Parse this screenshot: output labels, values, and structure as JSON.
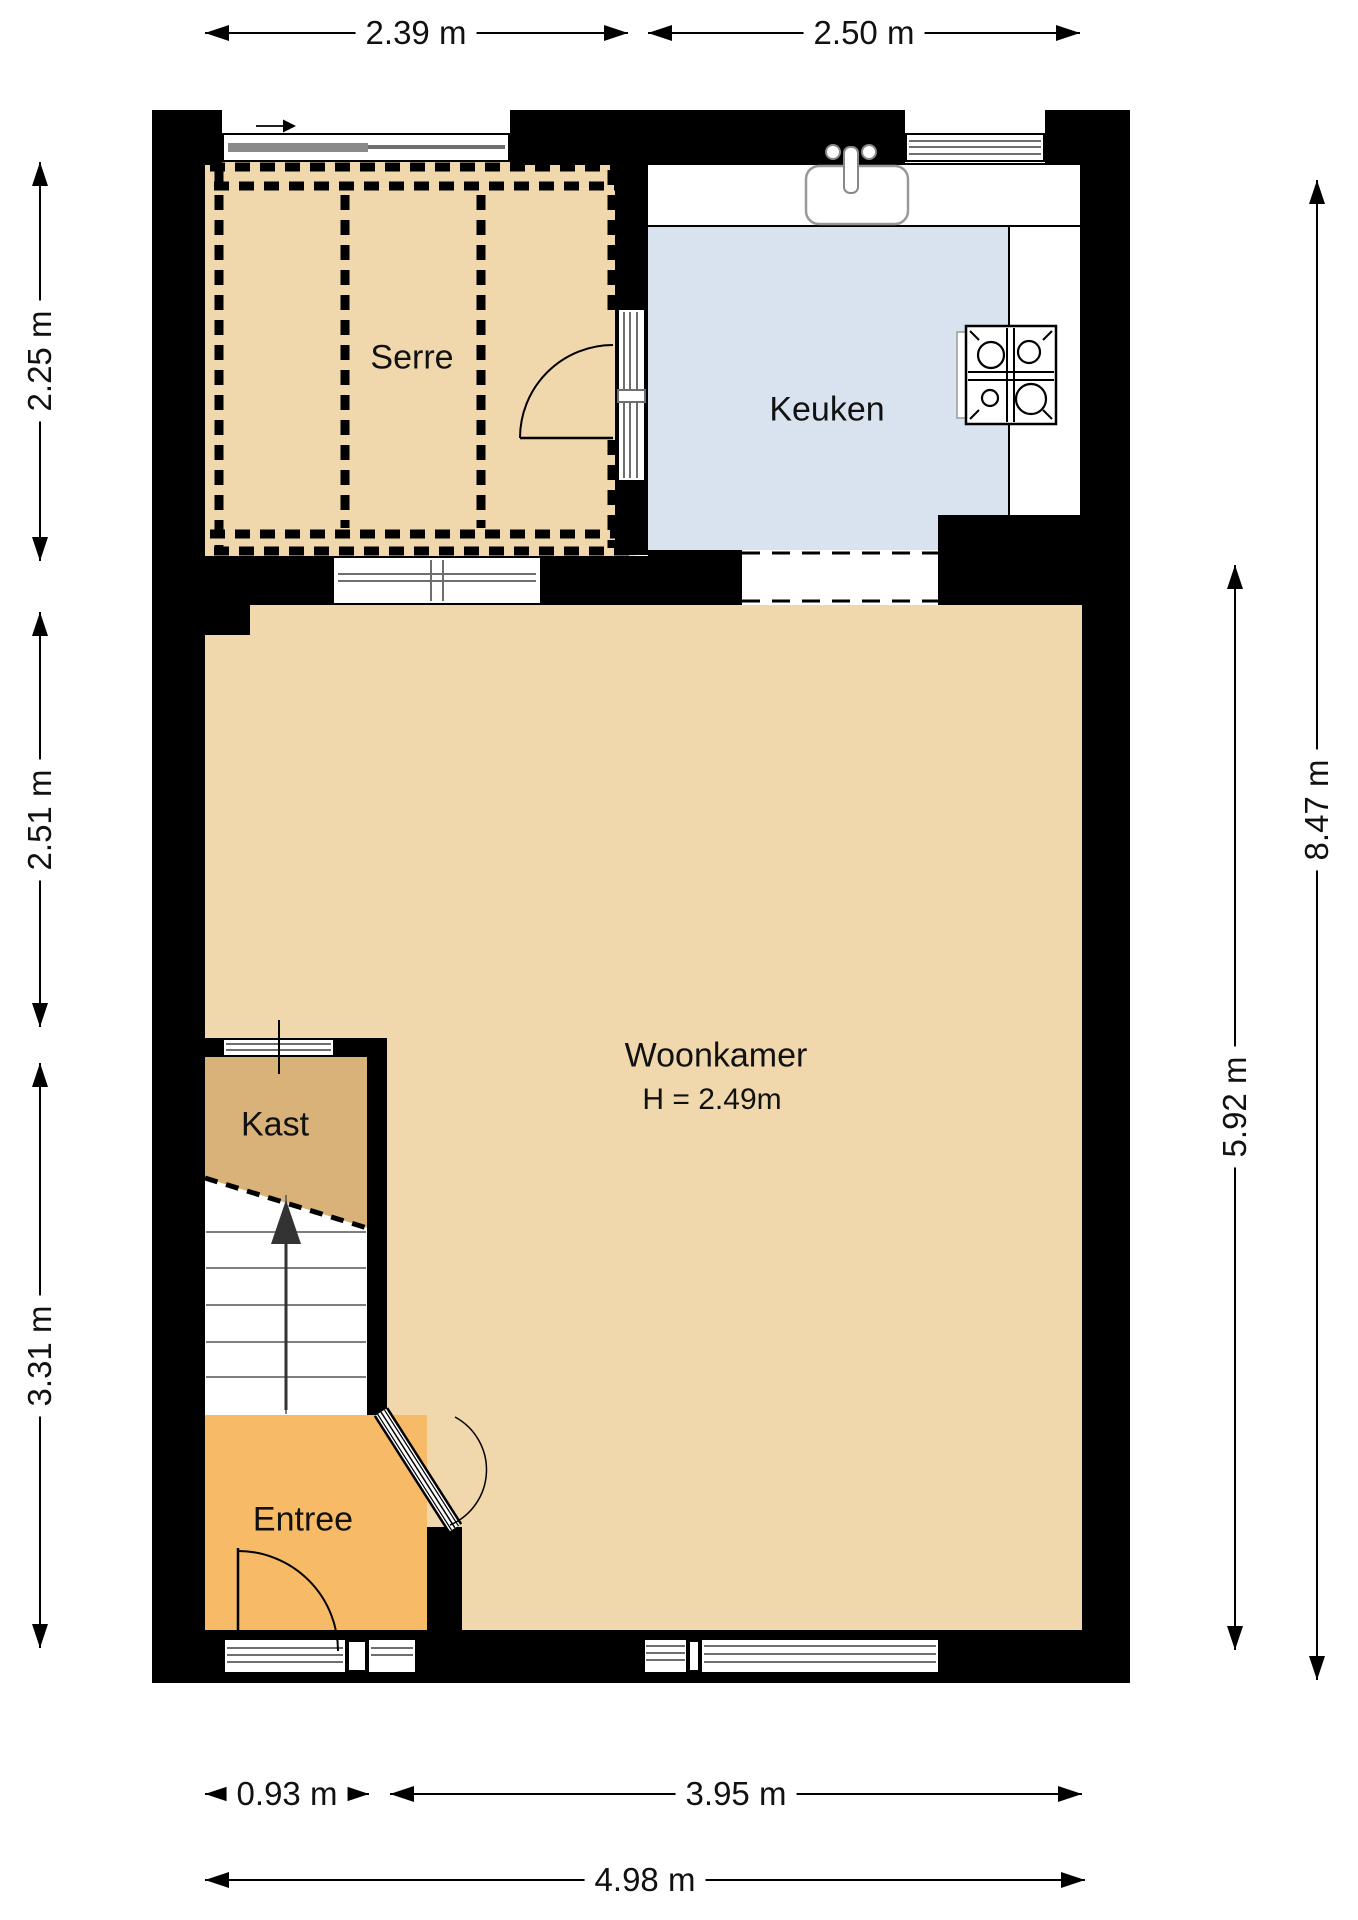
{
  "plan": {
    "rooms": {
      "serre": {
        "label": "Serre"
      },
      "keuken": {
        "label": "Keuken"
      },
      "woonkamer": {
        "label": "Woonkamer",
        "ceiling_height": "H = 2.49m"
      },
      "kast": {
        "label": "Kast"
      },
      "entree": {
        "label": "Entree"
      }
    },
    "dimensions": {
      "top_serre_width": "2.39 m",
      "top_keuken_width": "2.50 m",
      "left_serre_depth": "2.25 m",
      "left_woonkamer_upper_depth": "2.51 m",
      "left_lower_section_depth": "3.31 m",
      "right_total_depth": "8.47 m",
      "right_woonkamer_depth": "5.92 m",
      "bottom_stairs_entree_width": "0.93 m",
      "bottom_woonkamer_width": "3.95 m",
      "bottom_total_width": "4.98 m"
    },
    "colors": {
      "floor_main": "#F0D8AC",
      "floor_kast": "#D8B278",
      "floor_entree": "#F7BA66",
      "floor_keuken": "#D9E3F0",
      "wall": "#000000"
    },
    "icons": {
      "north_arrow": "north-arrow-icon",
      "sink": "sink-icon",
      "stove": "stove-icon",
      "stairs_arrow": "stairs-up-arrow-icon"
    }
  }
}
